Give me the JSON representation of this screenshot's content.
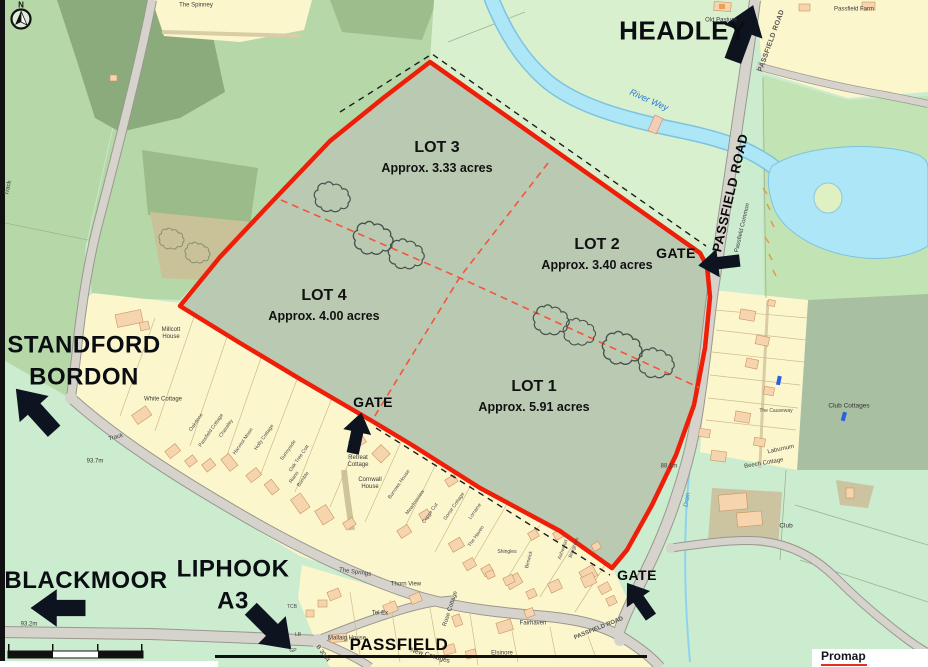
{
  "compass": {
    "letter": "N"
  },
  "logo": {
    "text": "Promap"
  },
  "colors": {
    "boundary_red": "#ee1e08",
    "lot_fill": "#bac9b2",
    "arrow_black": "#0d1420",
    "water_blue": "#ade6f6",
    "residential_yellow": "#fcf6cd"
  },
  "lots": [
    {
      "name": "LOT 3",
      "acreage": "Approx. 3.33 acres",
      "x": 437,
      "y": 148
    },
    {
      "name": "LOT 2",
      "acreage": "Approx. 3.40 acres",
      "x": 597,
      "y": 245
    },
    {
      "name": "LOT 4",
      "acreage": "Approx. 4.00 acres",
      "x": 324,
      "y": 296
    },
    {
      "name": "LOT 1",
      "acreage": "Approx. 5.91 acres",
      "x": 534,
      "y": 387
    }
  ],
  "gates": [
    {
      "label": "GATE",
      "x": 373,
      "y": 402,
      "arrow": {
        "x": 357,
        "y": 433,
        "rot": 12,
        "s": 0.95
      }
    },
    {
      "label": "GATE",
      "x": 676,
      "y": 253,
      "arrow": {
        "x": 719,
        "y": 263,
        "rot": -97,
        "s": 0.95
      }
    },
    {
      "label": "GATE",
      "x": 637,
      "y": 575,
      "arrow": {
        "x": 639,
        "y": 600,
        "rot": -35,
        "s": 0.95
      }
    }
  ],
  "directions": [
    {
      "label": "HEADLEY",
      "x": 683,
      "y": 31,
      "cls": "dir-xl",
      "arrow": {
        "x": 743,
        "y": 33,
        "rot": 20,
        "s": 1.35
      }
    },
    {
      "label": "STANDFORD\nBORDON",
      "x": 84,
      "y": 362,
      "arrow": {
        "x": 35,
        "y": 410,
        "rot": -42,
        "s": 1.3
      }
    },
    {
      "label": "BLACKMOOR",
      "x": 86,
      "y": 581,
      "arrow": {
        "x": 58,
        "y": 608,
        "rot": -90,
        "s": 1.25
      }
    },
    {
      "label": "LIPHOOK\nA3",
      "x": 233,
      "y": 586,
      "arrow": {
        "x": 271,
        "y": 629,
        "rot": 135,
        "s": 1.3
      }
    }
  ],
  "map_labels": [
    {
      "text": "N",
      "x": 21,
      "y": 5,
      "cls": "compass-n"
    },
    {
      "text": "The Spinney",
      "x": 196,
      "y": 6,
      "cls": "tiny"
    },
    {
      "text": "Passfield Farm",
      "x": 854,
      "y": 10,
      "cls": "tiny"
    },
    {
      "text": "Old Pasture",
      "x": 721,
      "y": 21,
      "cls": "tiny"
    },
    {
      "text": "PASSFIELD ROAD",
      "x": 772,
      "y": 41,
      "rot": -70,
      "cls": "roadlbl"
    },
    {
      "text": "River Wey",
      "x": 649,
      "y": 100,
      "rot": 24,
      "cls": "water-lbl"
    },
    {
      "text": "PASSFIELD ROAD",
      "x": 731,
      "y": 193,
      "rot": -77,
      "cls": "roadbold"
    },
    {
      "text": "Passfield Common",
      "x": 743,
      "y": 228,
      "rot": -77,
      "cls": "tiny"
    },
    {
      "text": "Club Cottages",
      "x": 849,
      "y": 406,
      "cls": "sm"
    },
    {
      "text": "The Causeway",
      "x": 776,
      "y": 412,
      "cls": "micro"
    },
    {
      "text": "Laburnum",
      "x": 781,
      "y": 450,
      "rot": -12,
      "cls": "tiny"
    },
    {
      "text": "Beech Cottage",
      "x": 764,
      "y": 464,
      "rot": -10,
      "cls": "tiny"
    },
    {
      "text": "Club",
      "x": 786,
      "y": 526,
      "cls": "sm"
    },
    {
      "text": "Millcott\nHouse",
      "x": 171,
      "y": 334,
      "cls": "tiny"
    },
    {
      "text": "White Cottage",
      "x": 163,
      "y": 400,
      "cls": "tiny"
    },
    {
      "text": "Track",
      "x": 116,
      "y": 438,
      "rot": -14,
      "cls": "tiny"
    },
    {
      "text": "Track",
      "x": 9,
      "y": 188,
      "rot": -78,
      "cls": "tiny"
    },
    {
      "text": "93.7m",
      "x": 95,
      "y": 462,
      "cls": "tiny"
    },
    {
      "text": "93.2m",
      "x": 29,
      "y": 625,
      "cls": "tiny"
    },
    {
      "text": "88.1m",
      "x": 669,
      "y": 467,
      "cls": "tiny"
    },
    {
      "text": "B 3004",
      "x": 322,
      "y": 654,
      "rot": 55,
      "cls": "tiny"
    },
    {
      "text": "TCB",
      "x": 292,
      "y": 608,
      "cls": "micro"
    },
    {
      "text": "LB",
      "x": 298,
      "y": 636,
      "cls": "micro"
    },
    {
      "text": "GP",
      "x": 293,
      "y": 652,
      "cls": "micro"
    },
    {
      "text": "Mallaig House",
      "x": 347,
      "y": 639,
      "cls": "tiny"
    },
    {
      "text": "New Cottages",
      "x": 430,
      "y": 656,
      "rot": 16,
      "cls": "sm"
    },
    {
      "text": "PASSFIELD",
      "x": 399,
      "y": 645,
      "cls": "village"
    },
    {
      "text": "The Springs",
      "x": 355,
      "y": 573,
      "rot": 8,
      "cls": "tiny"
    },
    {
      "text": "Thorn View",
      "x": 406,
      "y": 585,
      "cls": "tiny"
    },
    {
      "text": "Tel Ex",
      "x": 380,
      "y": 614,
      "cls": "tiny"
    },
    {
      "text": "Rose Cottage",
      "x": 451,
      "y": 609,
      "rot": -72,
      "cls": "tiny"
    },
    {
      "text": "Fairhaven",
      "x": 533,
      "y": 624,
      "cls": "tiny"
    },
    {
      "text": "Elsinore",
      "x": 502,
      "y": 654,
      "cls": "tiny"
    },
    {
      "text": "Retreat\nCottage",
      "x": 358,
      "y": 462,
      "cls": "tiny"
    },
    {
      "text": "Cornwall\nHouse",
      "x": 370,
      "y": 484,
      "cls": "tiny"
    },
    {
      "text": "Drain",
      "x": 688,
      "y": 500,
      "rot": -80,
      "cls": "water-micro"
    },
    {
      "text": "PASSFIELD ROAD",
      "x": 599,
      "y": 629,
      "rot": -22,
      "cls": "roadsm"
    },
    {
      "text": "Oakdene",
      "x": 197,
      "y": 423,
      "rot": -55,
      "cls": "micro"
    },
    {
      "text": "Passfield Cottage",
      "x": 212,
      "y": 431,
      "rot": -55,
      "cls": "micro"
    },
    {
      "text": "Chaseley",
      "x": 227,
      "y": 429,
      "rot": -55,
      "cls": "micro"
    },
    {
      "text": "Harvest Moon",
      "x": 244,
      "y": 442,
      "rot": -55,
      "cls": "micro"
    },
    {
      "text": "Holly Cottage",
      "x": 265,
      "y": 438,
      "rot": -55,
      "cls": "micro"
    },
    {
      "text": "Sunnyside",
      "x": 289,
      "y": 451,
      "rot": -55,
      "cls": "micro"
    },
    {
      "text": "Oak Tree Cott",
      "x": 300,
      "y": 459,
      "rot": -55,
      "cls": "micro"
    },
    {
      "text": "Riano",
      "x": 295,
      "y": 478,
      "rot": -55,
      "cls": "micro"
    },
    {
      "text": "Bumble",
      "x": 304,
      "y": 480,
      "rot": -55,
      "cls": "micro"
    },
    {
      "text": "Burrows House",
      "x": 400,
      "y": 485,
      "rot": -55,
      "cls": "micro"
    },
    {
      "text": "Meadowview",
      "x": 416,
      "y": 503,
      "rot": -55,
      "cls": "micro"
    },
    {
      "text": "Copse Cut",
      "x": 431,
      "y": 514,
      "rot": -55,
      "cls": "micro"
    },
    {
      "text": "Gorse Cottage",
      "x": 455,
      "y": 507,
      "rot": -55,
      "cls": "micro"
    },
    {
      "text": "Lorraine",
      "x": 476,
      "y": 512,
      "rot": -55,
      "cls": "micro"
    },
    {
      "text": "The Haven",
      "x": 477,
      "y": 537,
      "rot": -55,
      "cls": "micro"
    },
    {
      "text": "Shingles",
      "x": 507,
      "y": 553,
      "cls": "micro"
    },
    {
      "text": "Berwick",
      "x": 530,
      "y": 560,
      "rot": -75,
      "cls": "micro"
    },
    {
      "text": "Ashwood",
      "x": 564,
      "y": 550,
      "rot": -70,
      "cls": "micro"
    },
    {
      "text": "Boxgrove",
      "x": 575,
      "y": 548,
      "rot": -70,
      "cls": "micro"
    }
  ]
}
